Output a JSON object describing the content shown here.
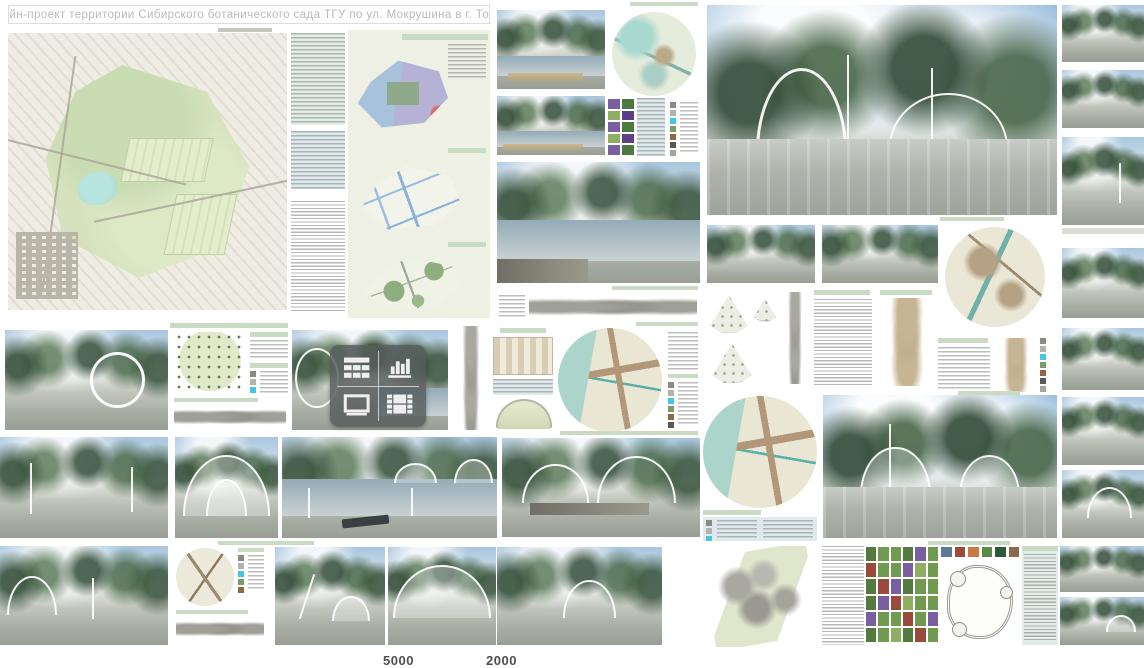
{
  "page": {
    "title": "Дизайн-проект территории Сибирского ботанического сада ТГУ по ул. Мокрушина в г. Томске"
  },
  "footer": {
    "scale_label_left": "5000",
    "scale_label_right": "2000"
  },
  "media_badge": {
    "icons": [
      "table-icon",
      "bar-chart-icon",
      "image-icon",
      "film-icon"
    ]
  },
  "colors": {
    "title_text": "#b7bcb7",
    "board_header_green": "#c9dcc3",
    "diagram_panel_bg": "#edf0e3",
    "info_box_blue": "#dfeaee",
    "zone_blue": "#a9c2dc",
    "zone_purple": "#b6b2d6",
    "zone_accent_red": "#d86a6a",
    "pond_cyan": "#9fd9d4",
    "map_water_teal": "#abd4ca",
    "legend_cyan": "#45c6e2",
    "badge_bg": "rgba(84,90,90,0.82)"
  }
}
